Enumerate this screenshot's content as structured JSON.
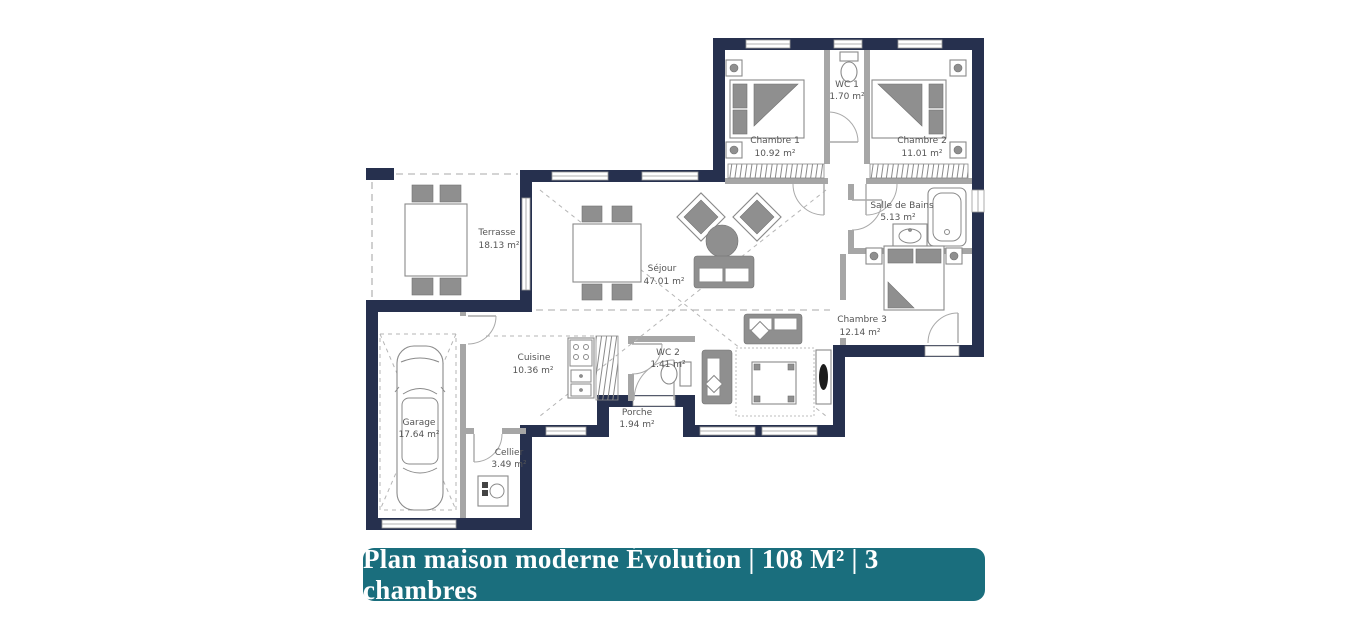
{
  "banner": {
    "label": "Plan maison moderne Évolution | 108 M² | 3 chambres"
  },
  "colors": {
    "wall": "#26304e",
    "banner_bg": "#1a6e7d",
    "banner_text": "#ffffff",
    "furniture_gray": "#8f8f8f",
    "line_gray": "#8a8a8a",
    "label_text": "#555555"
  },
  "rooms": [
    {
      "name": "Chambre 1",
      "area": "10.92 m²"
    },
    {
      "name": "WC 1",
      "area": "1.70 m²"
    },
    {
      "name": "Chambre 2",
      "area": "11.01 m²"
    },
    {
      "name": "Salle de Bains",
      "area": "5.13 m²"
    },
    {
      "name": "Chambre 3",
      "area": "12.14 m²"
    },
    {
      "name": "Séjour",
      "area": "47.01 m²"
    },
    {
      "name": "Terrasse",
      "area": "18.13 m²"
    },
    {
      "name": "Cuisine",
      "area": "10.36 m²"
    },
    {
      "name": "WC 2",
      "area": "1.41 m²"
    },
    {
      "name": "Porche",
      "area": "1.94 m²"
    },
    {
      "name": "Garage",
      "area": "17.64 m²"
    },
    {
      "name": "Cellier",
      "area": "3.49 m²"
    }
  ]
}
